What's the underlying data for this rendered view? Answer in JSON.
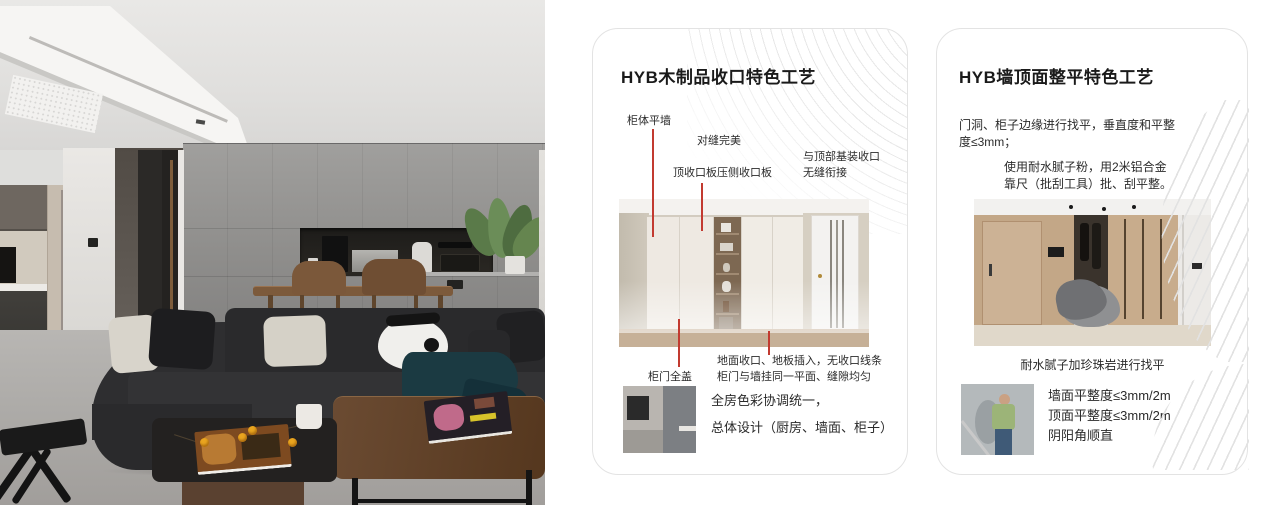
{
  "colors": {
    "accent_red": "#c23a30",
    "card_border": "#e3e3e3",
    "sofa_dark": "#2a2a2c",
    "wall_grey": "#8f8e8c",
    "blanket_teal": "#1b3a42"
  },
  "card1": {
    "title": "HYB木制品收口特色工艺",
    "callout_cabinet_wall": "柜体平墙",
    "callout_seam": "对缝完美",
    "callout_top_panel": "顶收口板压侧收口板",
    "callout_ceiling_1": "与顶部基装收口",
    "callout_ceiling_2": "无缝衔接",
    "callout_door_cover": "柜门全盖",
    "note_line1": "地面收口、地板插入，无收口线条",
    "note_line2": "柜门与墙挂同一平面、缝隙均匀",
    "summary_line1": "全房色彩协调统一，",
    "summary_line2": "总体设计（厨房、墙面、柜子）"
  },
  "card2": {
    "title": "HYB墙顶面整平特色工艺",
    "para1_line1": "门洞、柜子边缘进行找平，垂直度和平整",
    "para1_line2": "度≤3mm；",
    "para2_line1": "使用耐水腻子粉，用2米铝合金",
    "para2_line2": "靠尺（批刮工具）批、刮平整。",
    "caption": "耐水腻子加珍珠岩进行找平",
    "metric1": "墙面平整度≤3mm/2m",
    "metric2": "顶面平整度≤3mm/2m",
    "metric3": "阴阳角顺直"
  }
}
